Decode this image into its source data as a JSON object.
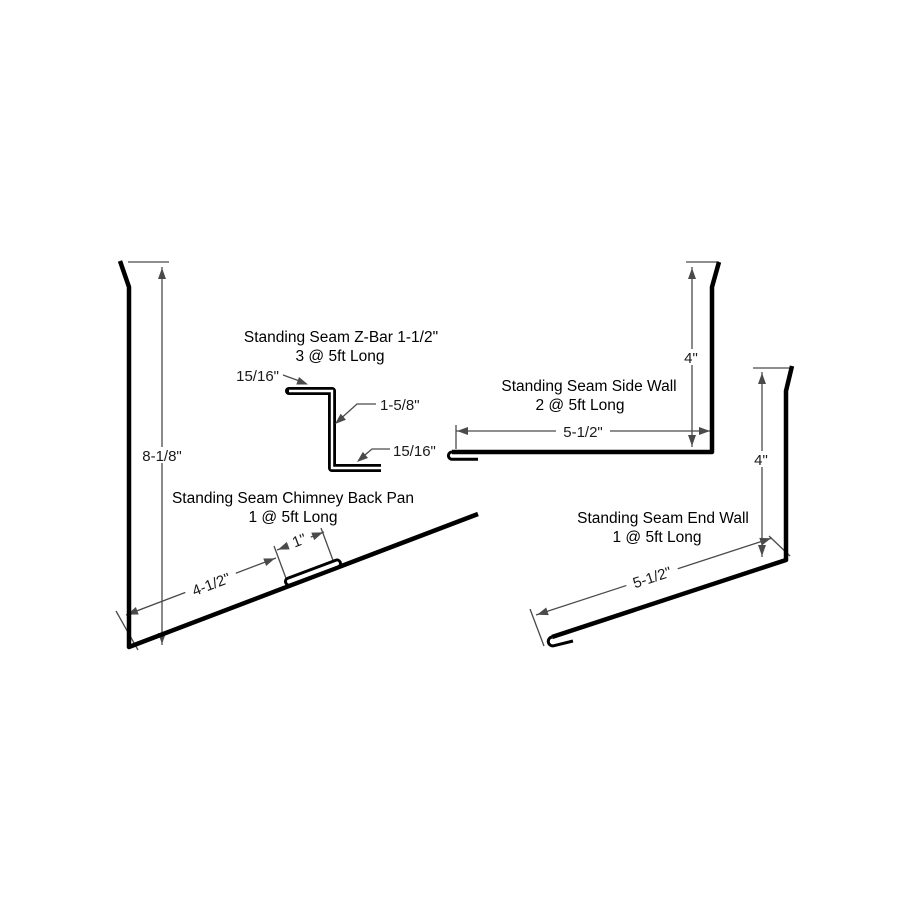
{
  "drawing": {
    "background_color": "#ffffff",
    "profile_color": "#000000",
    "dimension_color": "#4a4a4a",
    "parts": {
      "z_bar": {
        "title": "Standing Seam Z-Bar 1-1/2\"",
        "quantity": "3 @ 5ft Long",
        "dim_top_flange": "15/16\"",
        "dim_web": "1-5/8\"",
        "dim_bottom_flange": "15/16\""
      },
      "chimney_back_pan": {
        "title": "Standing Seam Chimney Back Pan",
        "quantity": "1 @ 5ft Long",
        "dim_vertical": "8-1/8\"",
        "dim_cleat": "1\"",
        "dim_pan": "4-1/2\""
      },
      "side_wall": {
        "title": "Standing Seam Side Wall",
        "quantity": "2 @ 5ft Long",
        "dim_vertical": "4\"",
        "dim_horizontal": "5-1/2\""
      },
      "end_wall": {
        "title": "Standing Seam End Wall",
        "quantity": "1 @ 5ft Long",
        "dim_vertical": "4\"",
        "dim_slope": "5-1/2\""
      }
    }
  }
}
